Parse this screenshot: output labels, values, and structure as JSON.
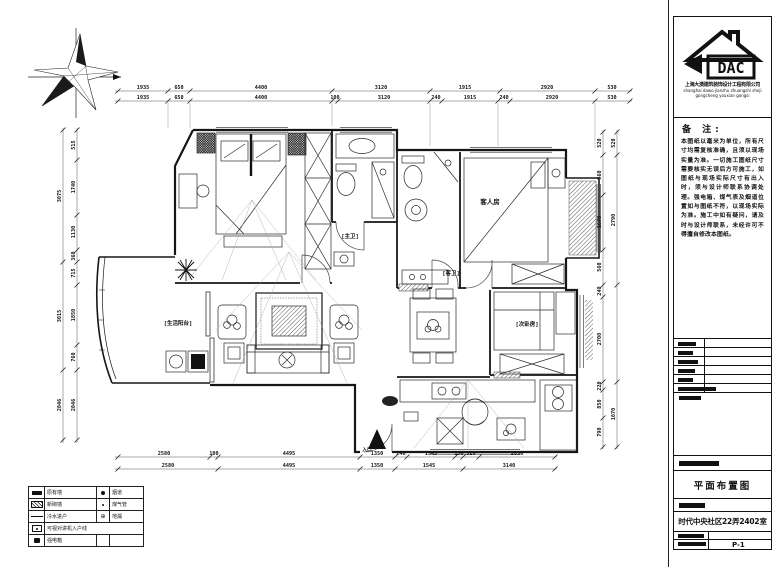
{
  "title_block": {
    "logo_text": "DAC",
    "company_cn": "上海大澳建筑装饰设计工程有限公司",
    "company_py1": "shanghai dawo jianzhu zhuangshi sheji",
    "company_py2": "gongcheng youxian gongsi",
    "notes_title": "备 注:",
    "notes_body": "本图纸以毫米为单位，所有尺寸均需复核准确，且须以现场实量为准。一切施工图纸尺寸需要核实无误后方可施工，如图纸与现场实际尺寸有出入时，须与设计师联系协调处理。强电箱、煤气表及烟道位置如与图纸不符，以现场实际为准。施工中如有疑问，请及时与设计师联系，未经许可不得擅自修改本图纸。",
    "drawing_title": "平面布置图",
    "project_name": "时代中央社区22弄2402室",
    "sheet_number": "P-1"
  },
  "rooms": {
    "master_bath_door": "[主卫]",
    "guest_room": "客人房",
    "guest_bath_door": "[客卫]",
    "second_bedroom": "[次卧房]",
    "living_balcony": "[生活阳台]",
    "entrance": "入口"
  },
  "legend": {
    "rows": [
      {
        "label": "原有墙",
        "label2": "烟道"
      },
      {
        "label": "新砌墙",
        "label2": "煤气管"
      },
      {
        "label": "冷水进户",
        "label2": "地漏"
      },
      {
        "label": "可视对讲机入户线",
        "label2": ""
      },
      {
        "label": "强电箱",
        "label2": ""
      }
    ],
    "drain_glyph": "⊕"
  },
  "dims": {
    "top_outer": [
      "1935",
      "650",
      "4400",
      "3120",
      "1915",
      "2920",
      "530"
    ],
    "top_inner": [
      "1935",
      "650",
      "4400",
      "100",
      "3120",
      "240",
      "1915",
      "240",
      "2920",
      "530"
    ],
    "bottom_inner": [
      "2580",
      "100",
      "4495",
      "1350",
      "240",
      "1545",
      "150",
      "520",
      "2830"
    ],
    "bottom_outer": [
      "2580",
      "4495",
      "1350",
      "1545",
      "3140"
    ],
    "left_outer": [
      "3075",
      "3015",
      "2046"
    ],
    "left_inner": [
      "515",
      "1740",
      "1130",
      "360",
      "715",
      "1850",
      "760",
      "2046"
    ],
    "right_inner": [
      "520",
      "560",
      "1670",
      "560",
      "240",
      "2700",
      "220",
      "850",
      "790"
    ],
    "right_outer": [
      "520",
      "2790",
      "1070"
    ]
  },
  "colors": {
    "line": "#161616",
    "dim_text": "#111111"
  }
}
